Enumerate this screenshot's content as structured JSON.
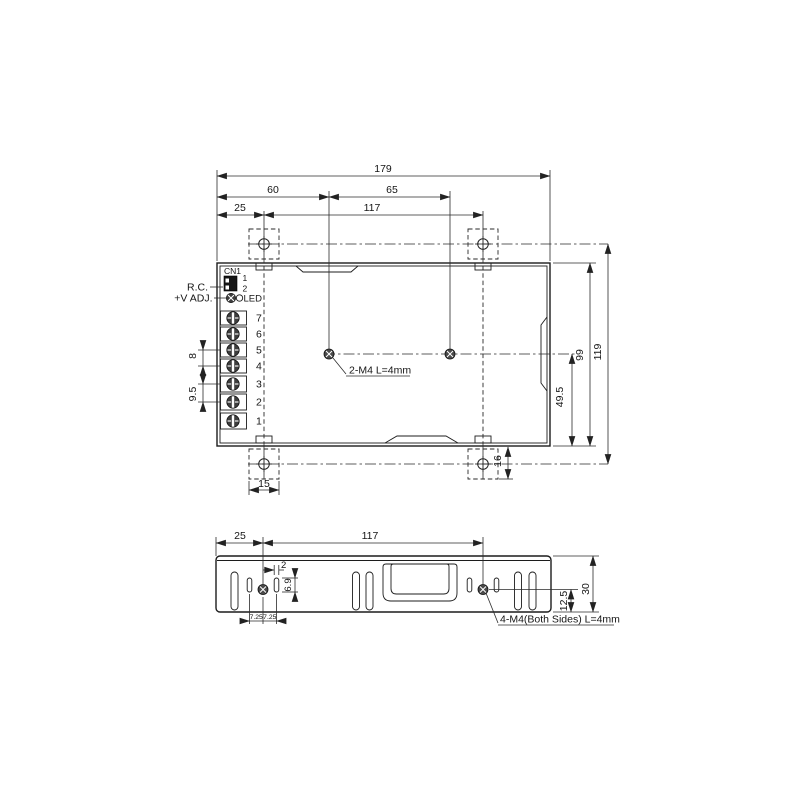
{
  "top_view": {
    "dims": {
      "total_width": "179",
      "hole_offset_left": "60",
      "hole_span": "65",
      "bracket_offset_left": "25",
      "bracket_span": "117",
      "pitch_small": "8",
      "pitch_large": "9.5",
      "hole_from_bottom": "49.5",
      "case_depth": "99",
      "overall_depth": "119",
      "bracket_height": "16",
      "bracket_width": "15"
    },
    "annotation_holes": "2-M4 L=4mm",
    "labels": {
      "remote_control": "R.C.",
      "connector": "CN1",
      "pin1": "1",
      "pin2": "2",
      "v_adjust": "+V ADJ.",
      "led": "LED"
    },
    "terminals": [
      "7",
      "6",
      "5",
      "4",
      "3",
      "2",
      "1"
    ]
  },
  "side_view": {
    "dims": {
      "bracket_offset_left": "25",
      "bracket_span": "117",
      "slot_width": "2",
      "slot_height": "6.9",
      "slot_offset_left": "7.25",
      "slot_offset_right": "7.25",
      "case_height": "30",
      "hole_from_bottom": "12.5"
    },
    "annotation_holes": "4-M4(Both Sides) L=4mm"
  }
}
